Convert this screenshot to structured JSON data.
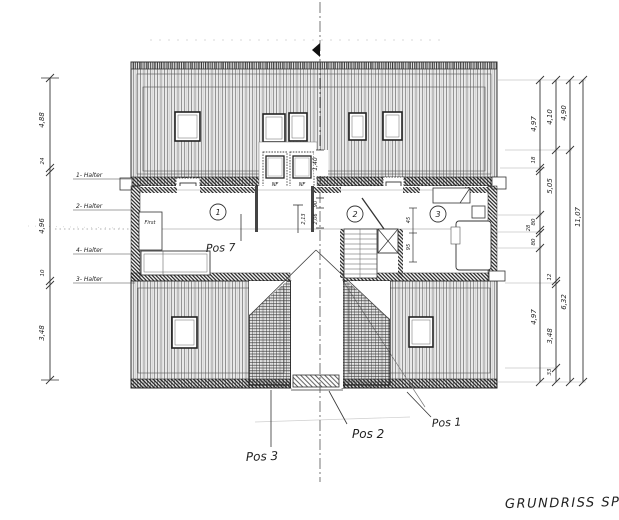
{
  "title": "GRUNDRISS SP",
  "pos_labels": {
    "pos1": "Pos 1",
    "pos2": "Pos 2",
    "pos3": "Pos 3",
    "pos7": "Pos 7"
  },
  "room_circles": [
    "1",
    "2",
    "3"
  ],
  "ridge_label": "First",
  "dormer_labels": {
    "df_top": "DF",
    "df_bottom": "N",
    "nf_top": "NF",
    "nf_bottom": "N"
  },
  "dims": {
    "left": [
      "4,88",
      "24",
      "4,96",
      "10",
      "3,48"
    ],
    "left_notes": [
      "1- Halter",
      "2- Halter",
      "4- Halter",
      "3- Halter"
    ],
    "right_chain1": [
      "4,97",
      "18",
      "80",
      "28",
      "80",
      "4,97"
    ],
    "right_chain2": [
      "4,10",
      "5,05",
      "12",
      "3,48",
      "33"
    ],
    "right_chain3": [
      "4,90",
      "6,32"
    ],
    "right_total": "11,07",
    "inner": {
      "roof_center": "1,40",
      "hall_a": "90",
      "hall_b": "2,06",
      "room1": "2,13",
      "stair_a": "45",
      "stair_b": "95"
    }
  }
}
